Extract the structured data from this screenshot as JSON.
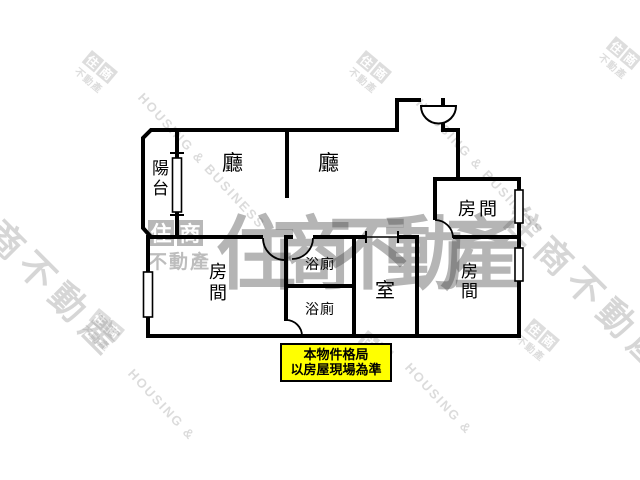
{
  "floorplan": {
    "rooms": [
      {
        "id": "balcony",
        "label": "陽台"
      },
      {
        "id": "living-left",
        "label": "廳"
      },
      {
        "id": "living-right",
        "label": "廳"
      },
      {
        "id": "bedroom-top-right",
        "label": "房間"
      },
      {
        "id": "bedroom-left",
        "label": "房間"
      },
      {
        "id": "bedroom-bottom-right",
        "label": "房間"
      },
      {
        "id": "bathroom-upper",
        "label": "浴廁"
      },
      {
        "id": "bathroom-lower",
        "label": "浴廁"
      },
      {
        "id": "room-center",
        "label": "室"
      }
    ],
    "wall_color": "#000000",
    "notice": {
      "line1": "本物件格局",
      "line2": "以房屋現場為準",
      "bg_color": "#ffff00",
      "border_color": "#000000",
      "text_color": "#000000"
    }
  },
  "watermarks": {
    "housing_full": "HOUSING & BUSINESS",
    "housing_short": "HOUSING &",
    "brand_name": "住商不動產",
    "stamp_char1": "住",
    "stamp_char2": "商",
    "stamp_text": "不動產",
    "color_light": "#c9c9c9",
    "color_mid": "#9a9a9a"
  }
}
